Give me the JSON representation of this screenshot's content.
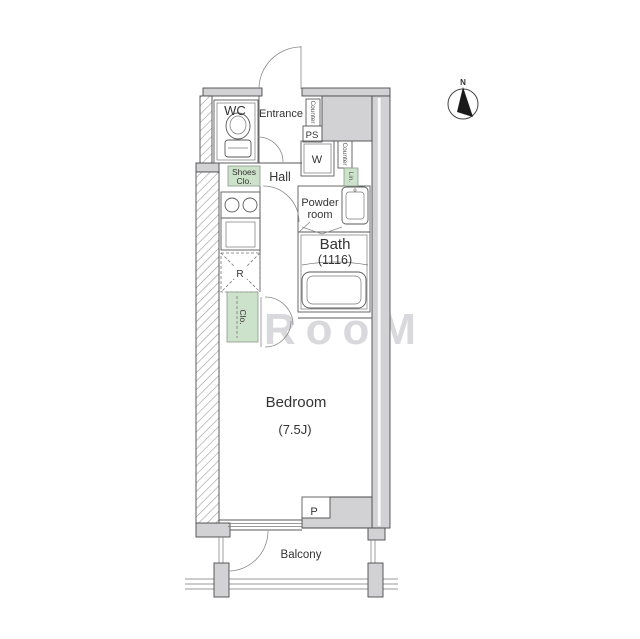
{
  "watermark": "RooM",
  "compass": {
    "north": "N"
  },
  "rooms": {
    "wc": "WC",
    "entrance": "Entrance",
    "hall": "Hall",
    "powder_line1": "Powder",
    "powder_line2": "room",
    "bath": "Bath",
    "bath_size": "(1116)",
    "bedroom": "Bedroom",
    "bedroom_size": "(7.5J)",
    "balcony": "Balcony"
  },
  "fixtures": {
    "shoes_line1": "Shoes",
    "shoes_line2": "Clo.",
    "counter_entrance": "Counter",
    "pipe_shaft": "PS",
    "washer": "W",
    "counter_powder": "Counter",
    "linen": "Lin.",
    "fridge": "R",
    "closet": "Clo.",
    "pipe": "P"
  },
  "colors": {
    "wall_fill": "#d2d2d4",
    "closet_green": "#cde2cb",
    "line": "#5a5a5a",
    "text": "#333333"
  }
}
